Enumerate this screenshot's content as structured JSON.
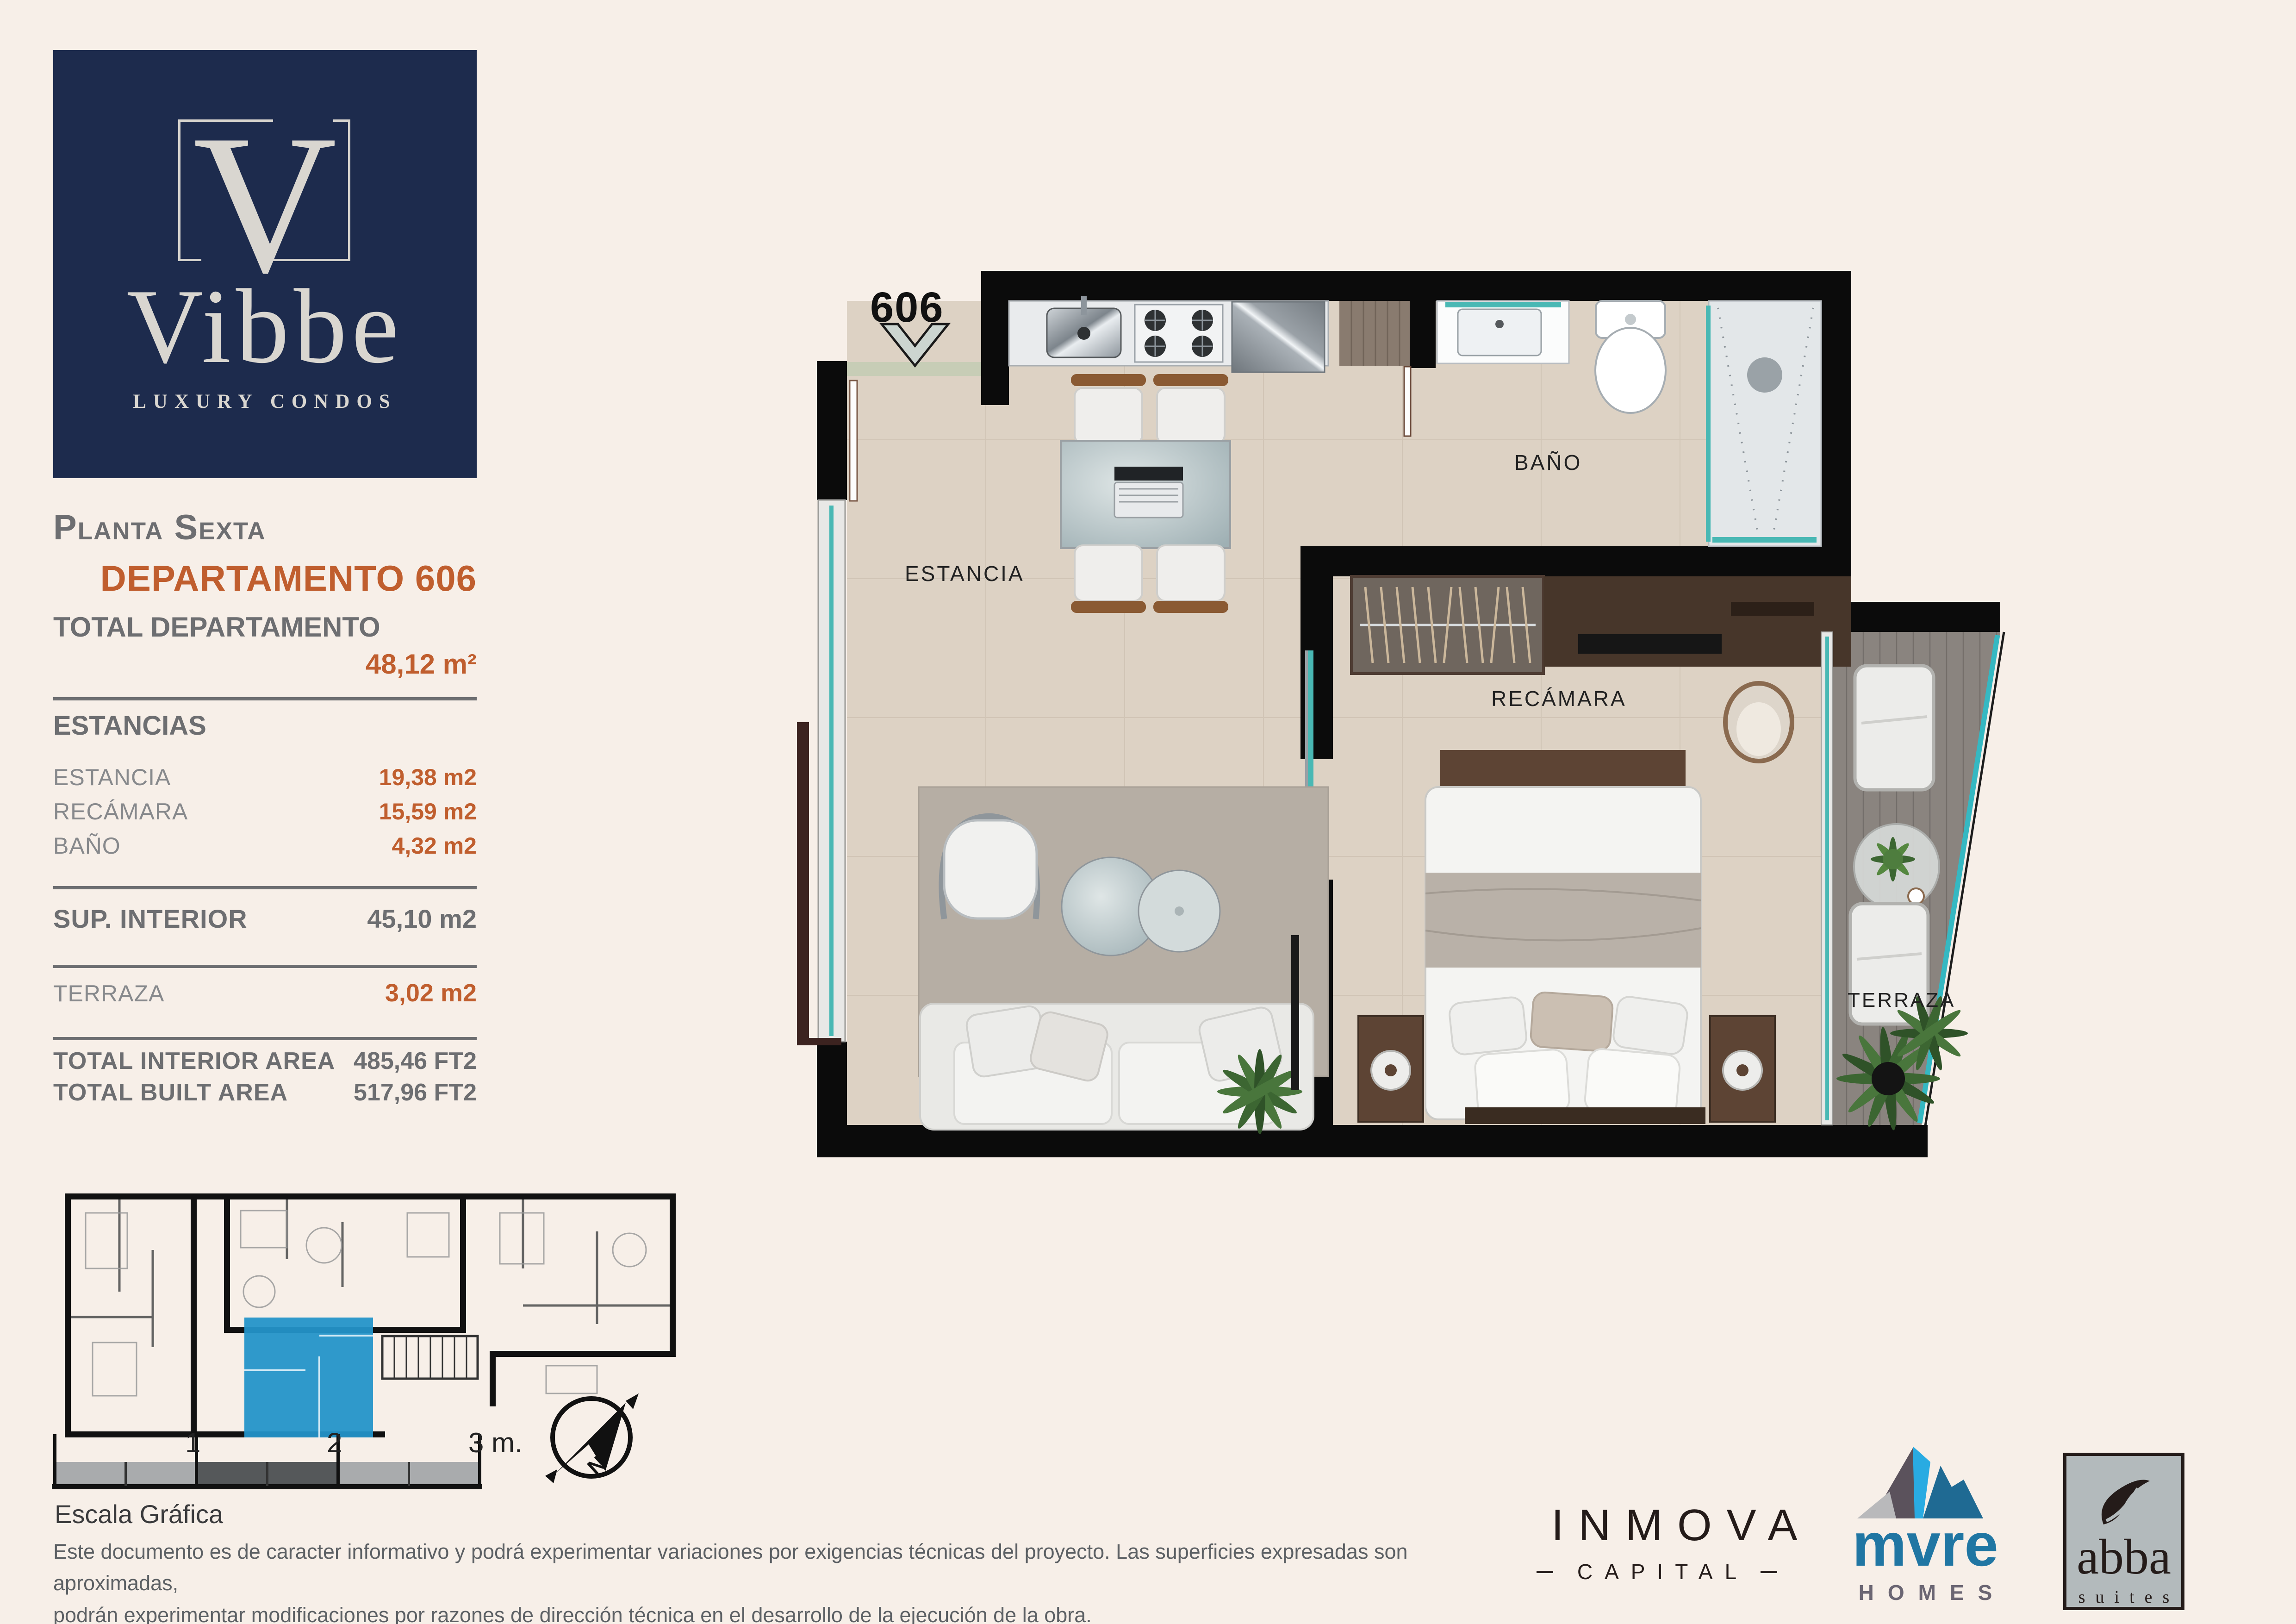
{
  "logo": {
    "monogram": "V",
    "brand": "Vibbe",
    "tagline": "LUXURY CONDOS"
  },
  "sidebar": {
    "floor_label": "Planta Sexta",
    "unit_title": "DEPARTAMENTO 606",
    "total_label": "TOTAL DEPARTAMENTO",
    "total_value": "48,12 m²",
    "estancias_heading": "ESTANCIAS",
    "rooms": [
      {
        "label": "ESTANCIA",
        "value": "19,38 m2"
      },
      {
        "label": "RECÁMARA",
        "value": "15,59 m2"
      },
      {
        "label": "BAÑO",
        "value": "4,32 m2"
      }
    ],
    "sup_interior_label": "SUP. INTERIOR",
    "sup_interior_value": "45,10 m2",
    "terraza_label": "TERRAZA",
    "terraza_value": "3,02 m2",
    "totals": [
      {
        "label": "TOTAL INTERIOR AREA",
        "value": "485,46 FT2"
      },
      {
        "label": "TOTAL BUILT AREA",
        "value": "517,96 FT2"
      }
    ]
  },
  "plan": {
    "unit_number": "606",
    "rooms": {
      "estancia": "ESTANCIA",
      "bano": "BAÑO",
      "recamara": "RECÁMARA",
      "terraza": "TERRAZA"
    }
  },
  "scale_bar": {
    "tick1": "1",
    "tick2": "2",
    "tick3": "3 m.",
    "caption": "Escala Gráfica"
  },
  "compass": {
    "north_label": "N"
  },
  "disclaimer": {
    "line1": "Este documento es de caracter informativo y podrá experimentar variaciones por exigencias técnicas del proyecto. Las superficies expresadas son aproximadas,",
    "line2": "podrán experimentar modificaciones por razones de dirección técnica en el desarrollo de la ejecución de la obra."
  },
  "footer_logos": {
    "inmova": {
      "name": "INMOVA",
      "sub": "CAPITAL"
    },
    "mure": {
      "name": "mvre",
      "sub": "HOMES"
    },
    "abba": {
      "name": "abba",
      "sub": "suites"
    }
  },
  "colors": {
    "background": "#f7efe8",
    "navy": "#1d2b4d",
    "orange": "#c05e2e",
    "gray_text": "#6d6e71",
    "light_gray_text": "#87898c",
    "wall_black": "#0b0b0b",
    "floor_beige": "#ddd2c4",
    "deck_gray": "#8a847f",
    "glass_teal": "#49b8b4",
    "keyplan_highlight": "#2493c9",
    "mure_blue": "#2076a3",
    "mure_lightblue": "#29abe2"
  }
}
